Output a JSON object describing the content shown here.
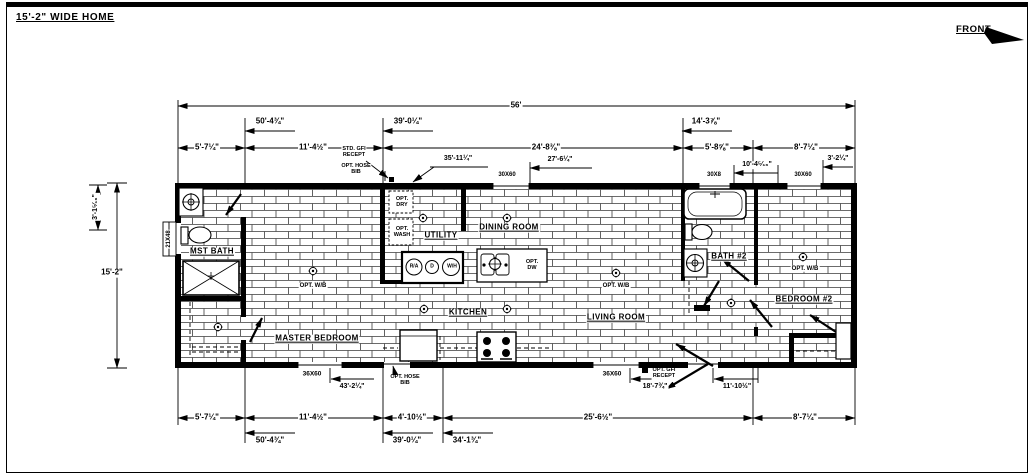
{
  "sheet": {
    "title": "15'-2\" WIDE HOME",
    "front_label": "FRONT"
  },
  "colors": {
    "line": "#000000",
    "paper": "#ffffff"
  },
  "rooms": {
    "mst_bath": "MST BATH",
    "master_bedroom": "MASTER BEDROOM",
    "utility": "UTILITY",
    "dining_room": "DINING ROOM",
    "kitchen": "KITCHEN",
    "living_room": "LIVING ROOM",
    "bath2": "BATH #2",
    "bedroom2": "BEDROOM #2"
  },
  "dims_top": {
    "overall": "56'",
    "run_50": "50'-4¾\"",
    "run_39": "39'-0¼\"",
    "run_14": "14'-3⅞\"",
    "seg1": "5'-7¼\"",
    "seg2": "11'-4½\"",
    "seg3": "24'-8⅜\"",
    "seg4": "5'-8⅝\"",
    "seg5": "8'-7¼\"",
    "leader_35": "35'-11¼\"",
    "leader_27": "27'-6¼\"",
    "leader_10": "10'-4⁵⁄₁₆\"",
    "leader_3": "3'-2¼\""
  },
  "dims_left": {
    "upper": "3'-1⁵⁄₁₆\"",
    "overall": "15'-2\"",
    "window": "21X48"
  },
  "dims_bottom": {
    "seg1": "5'-7¼\"",
    "seg2": "11'-4½\"",
    "seg3": "4'-10½\"",
    "seg4": "25'-6½\"",
    "seg5": "8'-7¼\"",
    "run_50": "50'-4¾\"",
    "run_39": "39'-0¼\"",
    "run_34": "34'-1¾\"",
    "leader_43": "43'-2¼\"",
    "leader_18": "18'-7¾\"",
    "leader_11": "11'-10½\""
  },
  "windows": {
    "top_a": "30X60",
    "top_b": "30X8",
    "top_c": "30X60",
    "bottom_a": "36X60",
    "bottom_b": "36X60"
  },
  "notes": {
    "std_gfi": "STD. GFI\nRECEPT",
    "opt_hose_top": "OPT. HOSE\nBIB",
    "opt_hose_bottom": "OPT. HOSE\nBIB",
    "opt_gfi_bottom": "OPT. GFI\nRECEPT",
    "opt_dry": "OPT.\nDRY",
    "opt_wash": "OPT.\nWASH",
    "opt_dw": "OPT.\nDW",
    "opt_wb": "OPT. W/B"
  },
  "equipment": {
    "ra": "R/A",
    "d": "D",
    "wh": "W/H"
  }
}
